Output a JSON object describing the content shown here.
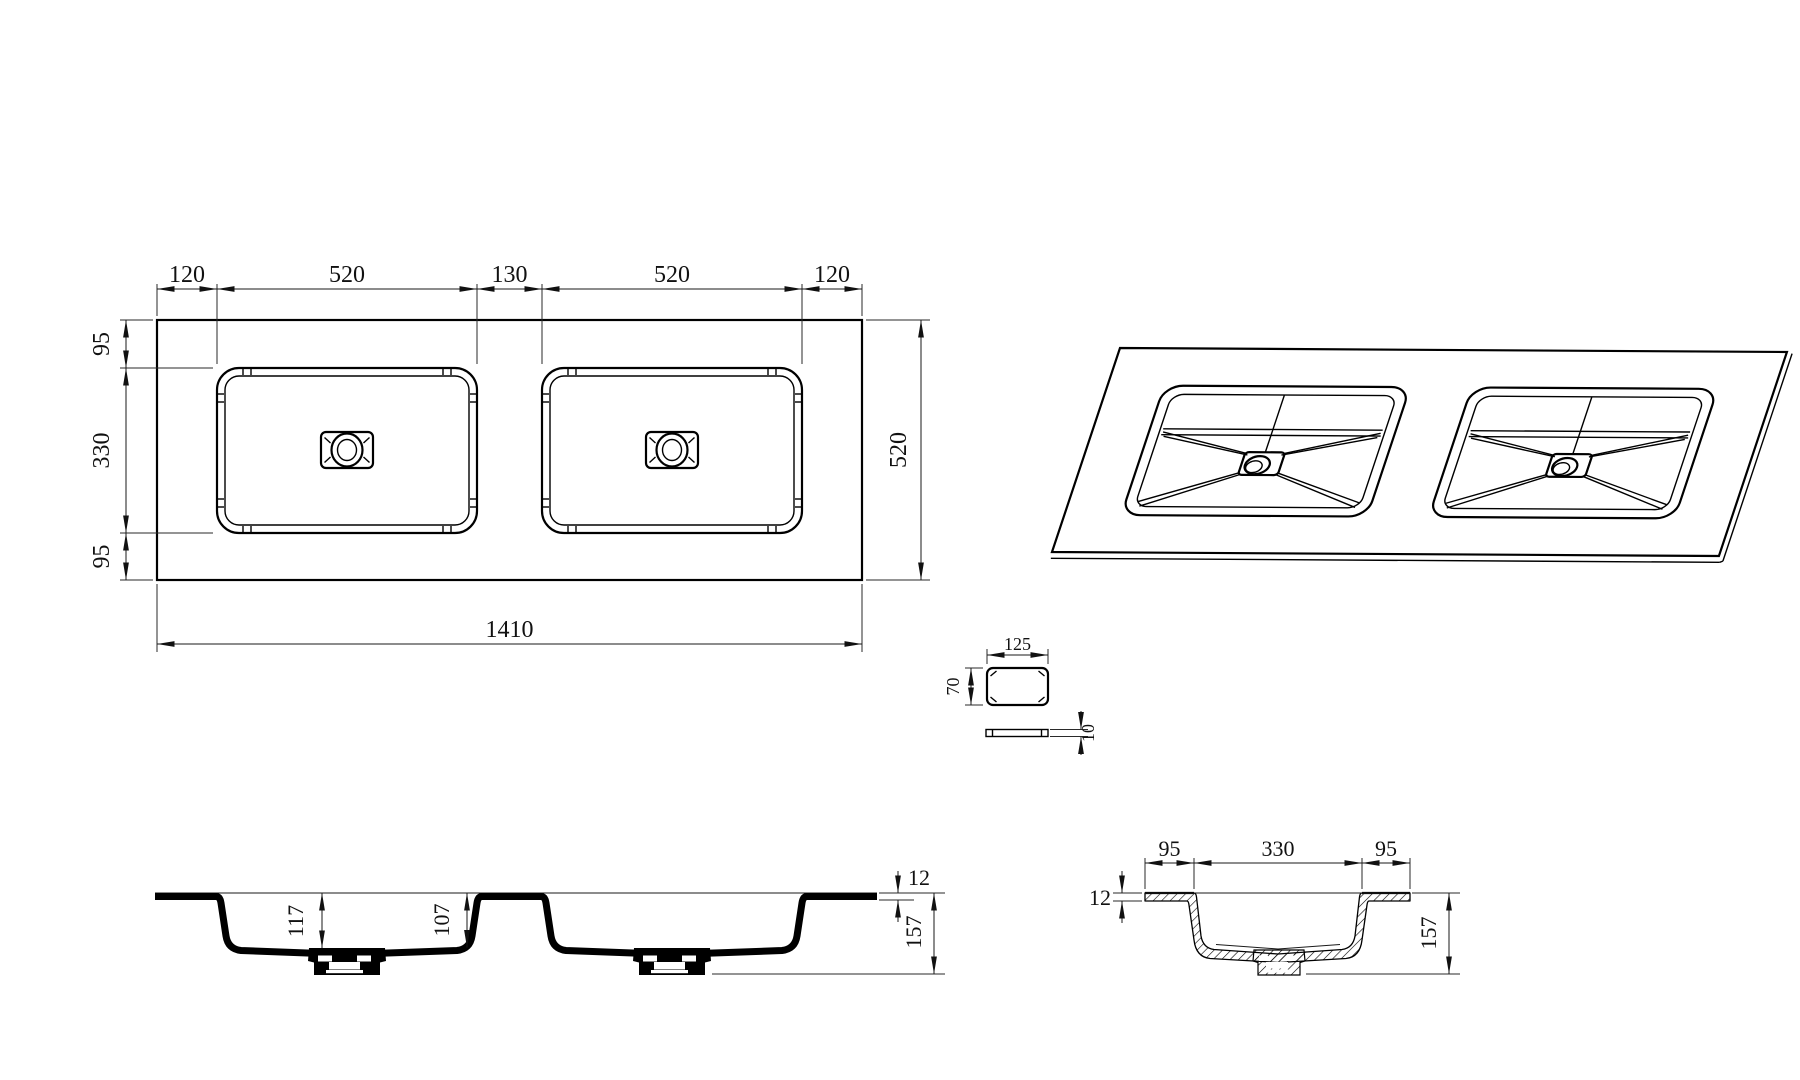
{
  "meta": {
    "background_color": "#ffffff",
    "line_color": "#000000",
    "drawing_subject": "double basin vanity countertop"
  },
  "plan": {
    "top_dims": [
      "120",
      "520",
      "130",
      "520",
      "120"
    ],
    "left_dims": [
      "95",
      "330",
      "95"
    ],
    "right_dim": "520",
    "bottom_dim": "1410"
  },
  "detail": {
    "width_dim": "125",
    "height_dim": "70",
    "thickness_dim": "10"
  },
  "front_section": {
    "depth_left_dim": "117",
    "depth_right_dim": "107",
    "thickness_dim": "12",
    "height_dim": "157"
  },
  "side_section": {
    "top_dims": [
      "95",
      "330",
      "95"
    ],
    "thickness_dim": "12",
    "height_dim": "157"
  }
}
